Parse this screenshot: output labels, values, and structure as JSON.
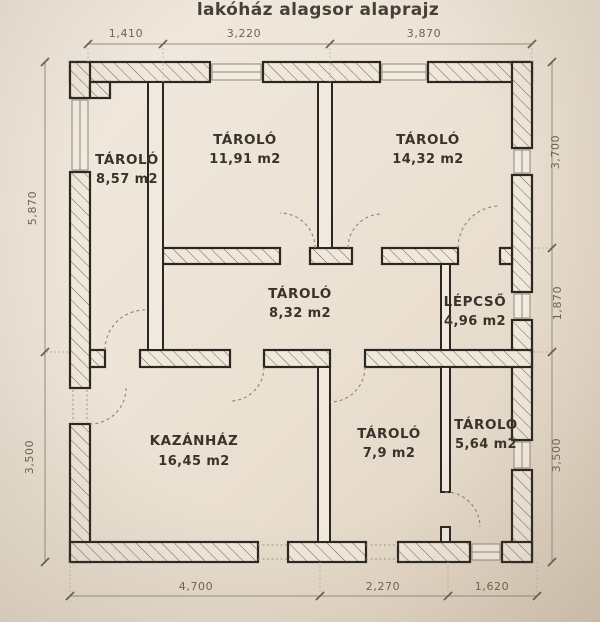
{
  "title": "lakóház alagsor alaprajz",
  "rooms": [
    {
      "name": "TÁROLÓ",
      "area": "8,57 m2"
    },
    {
      "name": "TÁROLÓ",
      "area": "11,91 m2"
    },
    {
      "name": "TÁROLÓ",
      "area": "14,32 m2"
    },
    {
      "name": "TÁROLÓ",
      "area": "8,32 m2"
    },
    {
      "name": "LÉPCSŐ",
      "area": "4,96 m2"
    },
    {
      "name": "KAZÁNHÁZ",
      "area": "16,45 m2"
    },
    {
      "name": "TÁROLÓ",
      "area": "7,9 m2"
    },
    {
      "name": "TÁROLÓ",
      "area": "5,64 m2"
    }
  ],
  "dimensions": {
    "top": [
      "1,410",
      "3,220",
      "3,870"
    ],
    "bottom": [
      "4,700",
      "2,270",
      "1,620"
    ],
    "left": [
      "5,870",
      "3,500"
    ],
    "right": [
      "3,700",
      "1,870",
      "3,500"
    ]
  },
  "colors": {
    "paper": "#ece3d7",
    "wall_line": "#2b2722",
    "label": "#39332c",
    "dimension": "#6e6453"
  }
}
